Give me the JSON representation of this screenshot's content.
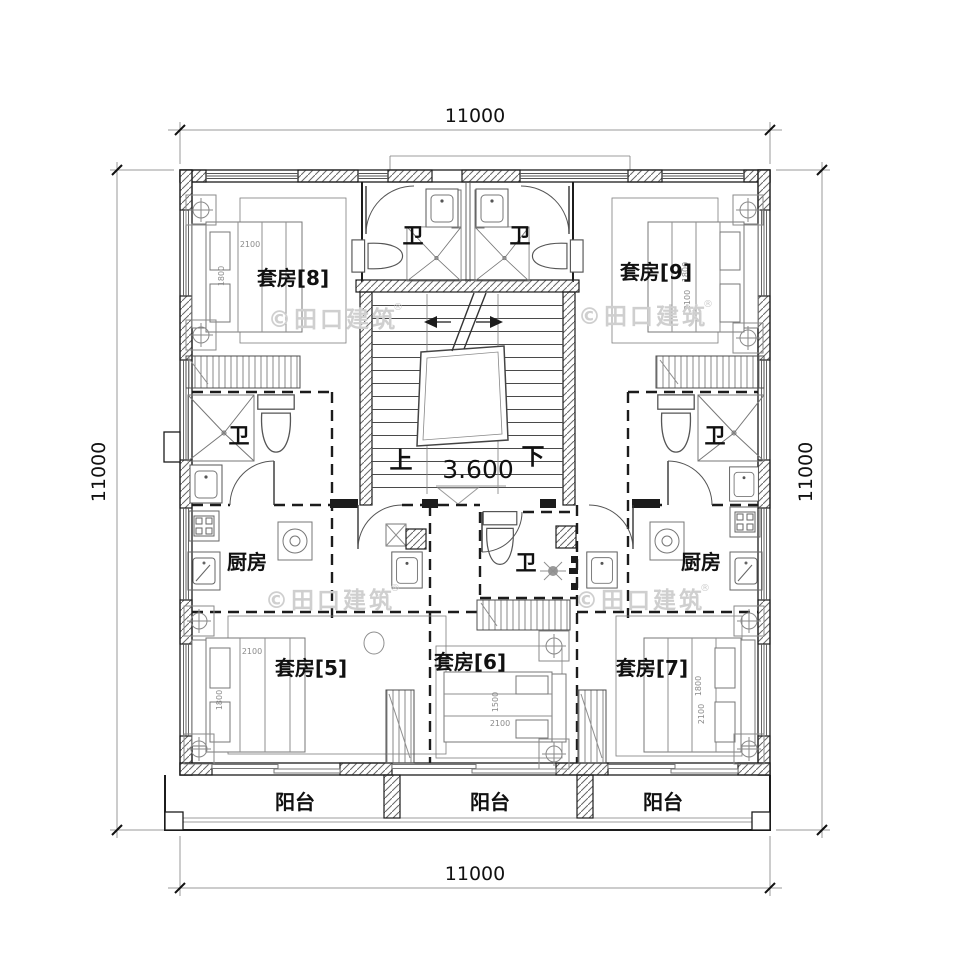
{
  "drawing": {
    "dimensions": {
      "top": "11000",
      "bottom": "11000",
      "left": "11000",
      "right": "11000"
    },
    "stair": {
      "up_label": "上",
      "down_label": "下",
      "level": "3.600"
    },
    "rooms": {
      "suite_8": "套房[8]",
      "suite_9": "套房[9]",
      "suite_5": "套房[5]",
      "suite_6": "套房[6]",
      "suite_7": "套房[7]",
      "bathroom": "卫",
      "kitchen": "厨房",
      "balcony": "阳台"
    },
    "bed_dims": {
      "w2100": "2100",
      "w1800": "1800",
      "w1500": "1500"
    },
    "watermark": {
      "text": "©田口建筑",
      "registered": "®"
    },
    "colors": {
      "line": "#1c1c1c",
      "furniture": "#8f8f8f",
      "watermark": "#cfcfcf",
      "background": "#ffffff"
    }
  }
}
